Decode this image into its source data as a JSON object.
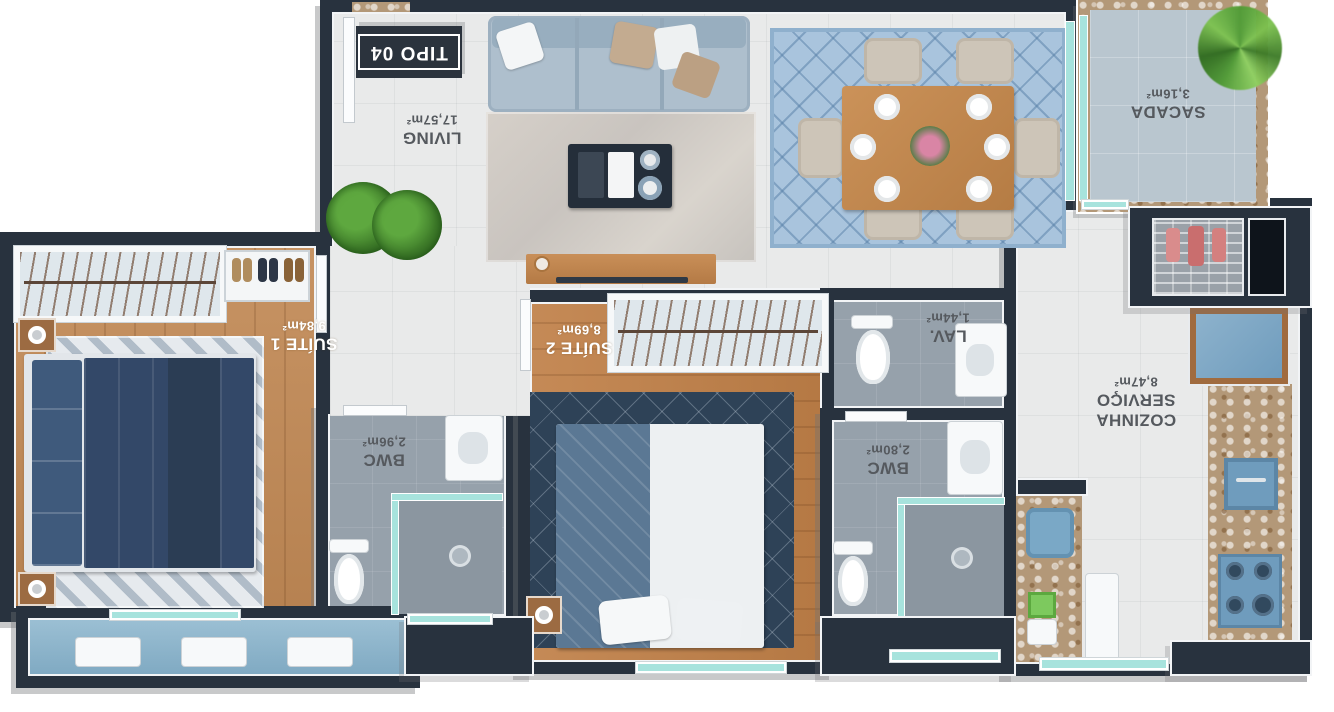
{
  "badge": {
    "text": "TIPO 04"
  },
  "rooms": {
    "living": {
      "name": "LIVING",
      "area": "17,57m²"
    },
    "sacada": {
      "name": "SACADA",
      "area": "3,16m²"
    },
    "suite1": {
      "name": "SUÍTE 1",
      "area": "9,84m²"
    },
    "suite2": {
      "name": "SUÍTE 2",
      "area": "8,69m²"
    },
    "lav": {
      "name": "LAV.",
      "area": "1,44m²"
    },
    "cozinha": {
      "name_line1": "COZINHA",
      "name_line2": "SERVIÇO",
      "area": "8,47m²"
    },
    "bwc1": {
      "name": "BWC",
      "area": "2,96m²"
    },
    "bwc2": {
      "name": "BWC",
      "area": "2,80m²"
    }
  },
  "colors": {
    "wall": "#28323e",
    "wood_floor": "#c28a56",
    "tile_floor": "#e9eaea",
    "bath_floor": "#96a1ab",
    "sacada_floor": "#b9c6cf",
    "granite_counter": "#b39878",
    "teal_glass": "#a7e3dd",
    "kitchen_blue": "#6f9cbd",
    "bed_navy": "#334868",
    "label_dark": "#55595e",
    "label_light": "#ffffff"
  }
}
